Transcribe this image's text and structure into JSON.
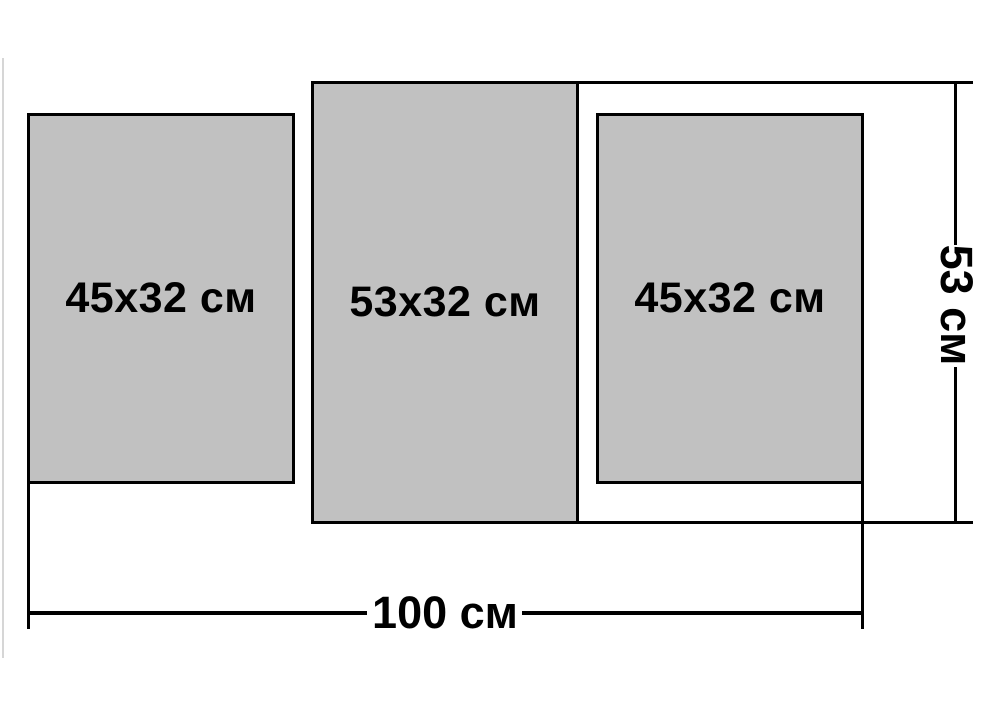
{
  "diagram": {
    "panels": [
      {
        "id": "left",
        "label": "45x32 см"
      },
      {
        "id": "middle",
        "label": "53x32 см"
      },
      {
        "id": "right",
        "label": "45x32 см"
      }
    ],
    "dimensions": {
      "total_width_label": "100 см",
      "total_height_label": "53 см"
    },
    "colors": {
      "panel_fill": "#c1c1c1",
      "panel_border": "#000000",
      "line": "#000000",
      "text": "#000000",
      "background": "#ffffff",
      "edge_artifact": "#d6d6d6"
    }
  }
}
